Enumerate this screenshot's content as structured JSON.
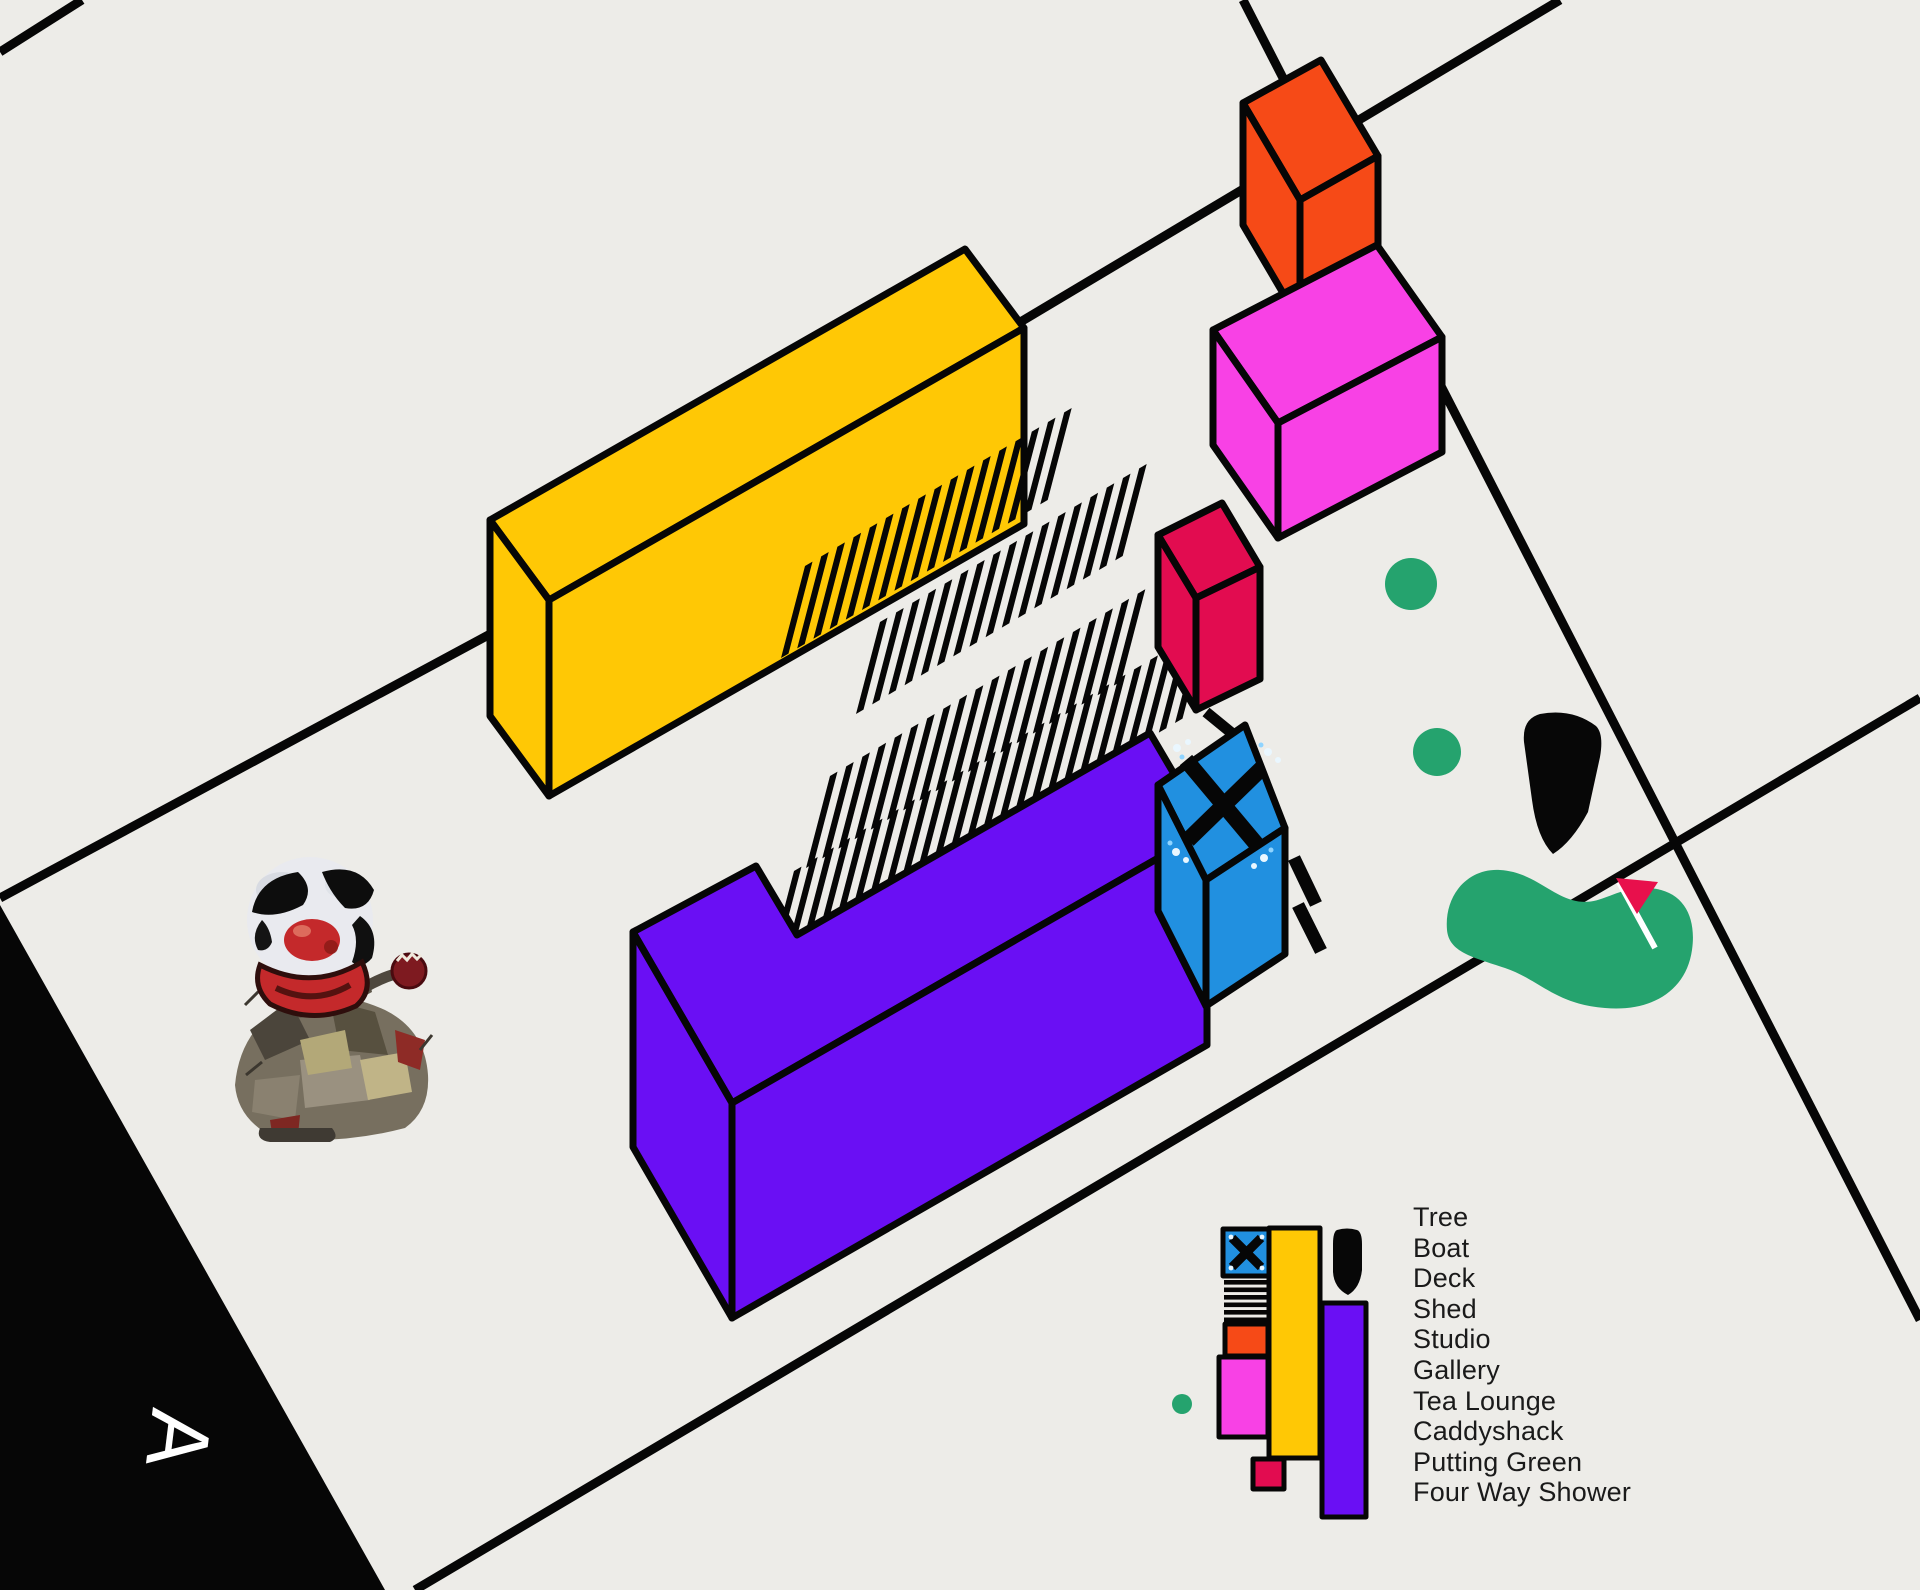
{
  "plan": {
    "section_letter": "A",
    "legend": {
      "items": [
        "Tree",
        "Boat",
        "Deck",
        "Shed",
        "Studio",
        "Gallery",
        "Tea Lounge",
        "Caddyshack",
        "Putting Green",
        "Four Way Shower"
      ]
    },
    "colors": {
      "background": "#EDECE8",
      "ink": "#060606",
      "shed": "#FFC805",
      "tea_lounge": "#6A0FF4",
      "studio": "#F64A17",
      "gallery": "#F841E5",
      "caddyshack": "#E20C50",
      "four_way_shower": "#2190E0",
      "shower_spray": "#BFE9FF",
      "tree": "#25A36E",
      "putting_green": "#25A36E",
      "flag": "#E8104C",
      "flag_pole": "#FFFFFF",
      "boat": "#070707",
      "section_letter": "#FFFFFF",
      "legend_text": "#1A1A1A"
    }
  }
}
